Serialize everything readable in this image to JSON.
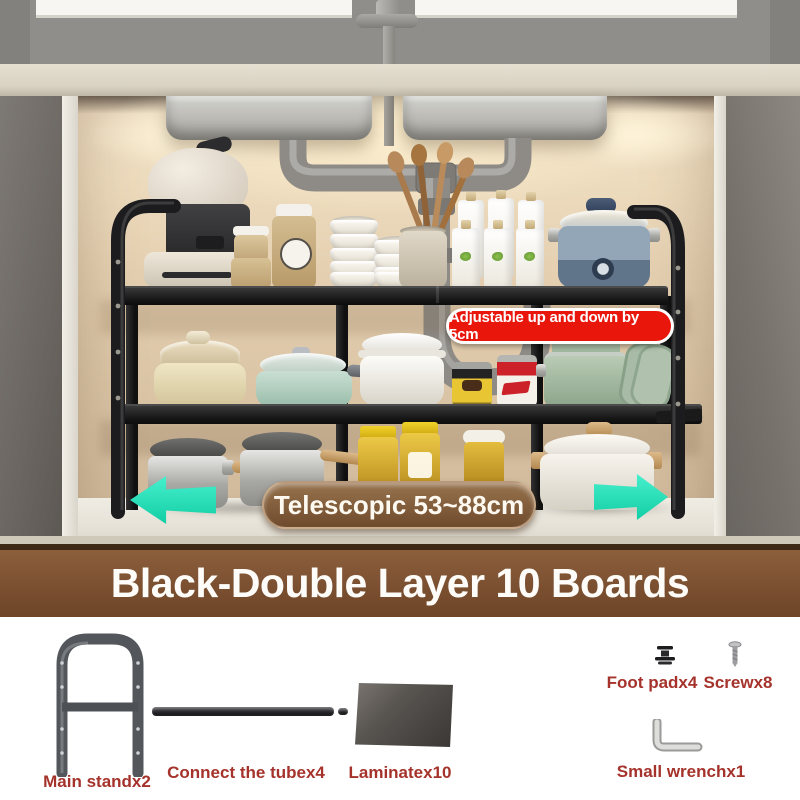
{
  "scene": {
    "badge_adjustable": "Adjustable up and down by 5cm",
    "pill_telescopic": "Telescopic 53~88cm"
  },
  "banner": {
    "title": "Black-Double Layer 10 Boards"
  },
  "parts": {
    "main_stand": "Main standx2",
    "connect_tube": "Connect the tubex4",
    "laminate": "Laminatex10",
    "foot_pad": "Foot padx4",
    "screw": "Screwx8",
    "small_wrench": "Small wrenchx1"
  },
  "colors": {
    "badge_red": "#e9160c",
    "pill_brown": "#7d5434",
    "banner_brown": "#7b5031",
    "arrow_teal": "#2be4bc",
    "label_red": "#a5332b",
    "shelf_black": "#161616"
  }
}
